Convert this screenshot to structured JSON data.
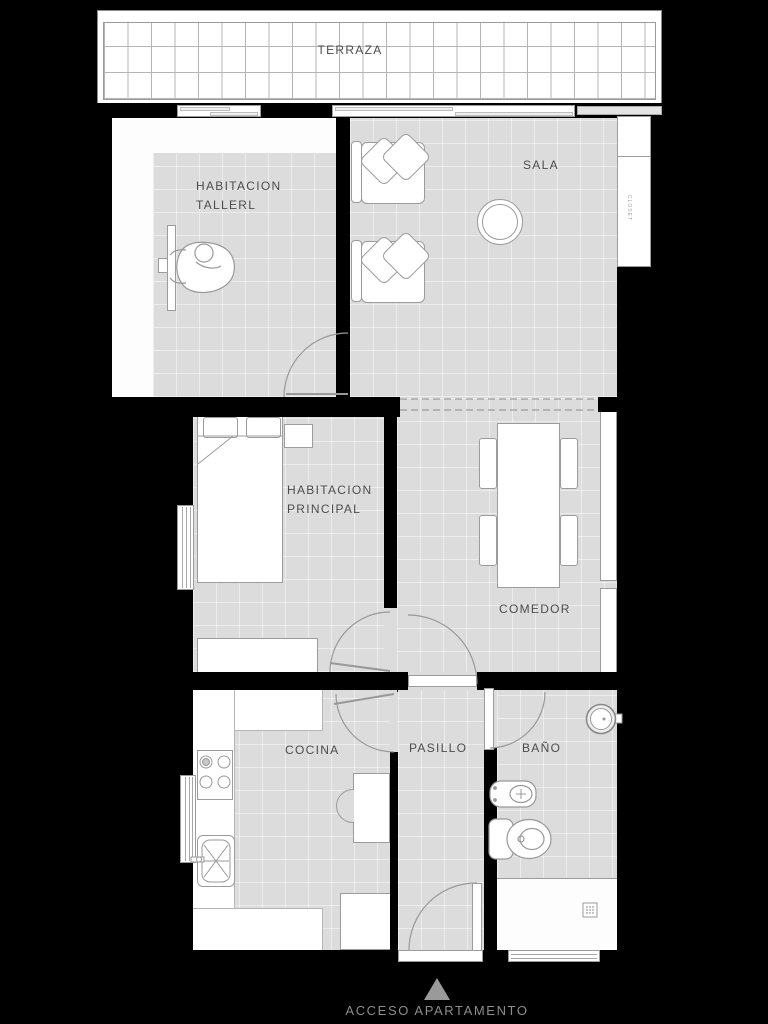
{
  "rooms": {
    "terraza": "TERRAZA",
    "sala": "SALA",
    "taller": "HABITACION\nTALLERL",
    "principal": "HABITACION\nPRINCIPAL",
    "comedor": "COMEDOR",
    "cocina": "COCINA",
    "pasillo": "PASILLO",
    "bano": "BAÑO"
  },
  "annotations": {
    "access": "ACCESO APARTAMENTO",
    "closet": "CLOSET"
  },
  "colors": {
    "background": "#000000",
    "wall": "#000000",
    "floor": "#dcdcdc",
    "furniture": "#ffffff",
    "outline": "#9c9c9c",
    "terrace_grid": "#b5b5b5",
    "room_label": "#4d4d4d",
    "access_label": "#8c8c8c",
    "entrance_triangle": "#9a9a9a"
  }
}
